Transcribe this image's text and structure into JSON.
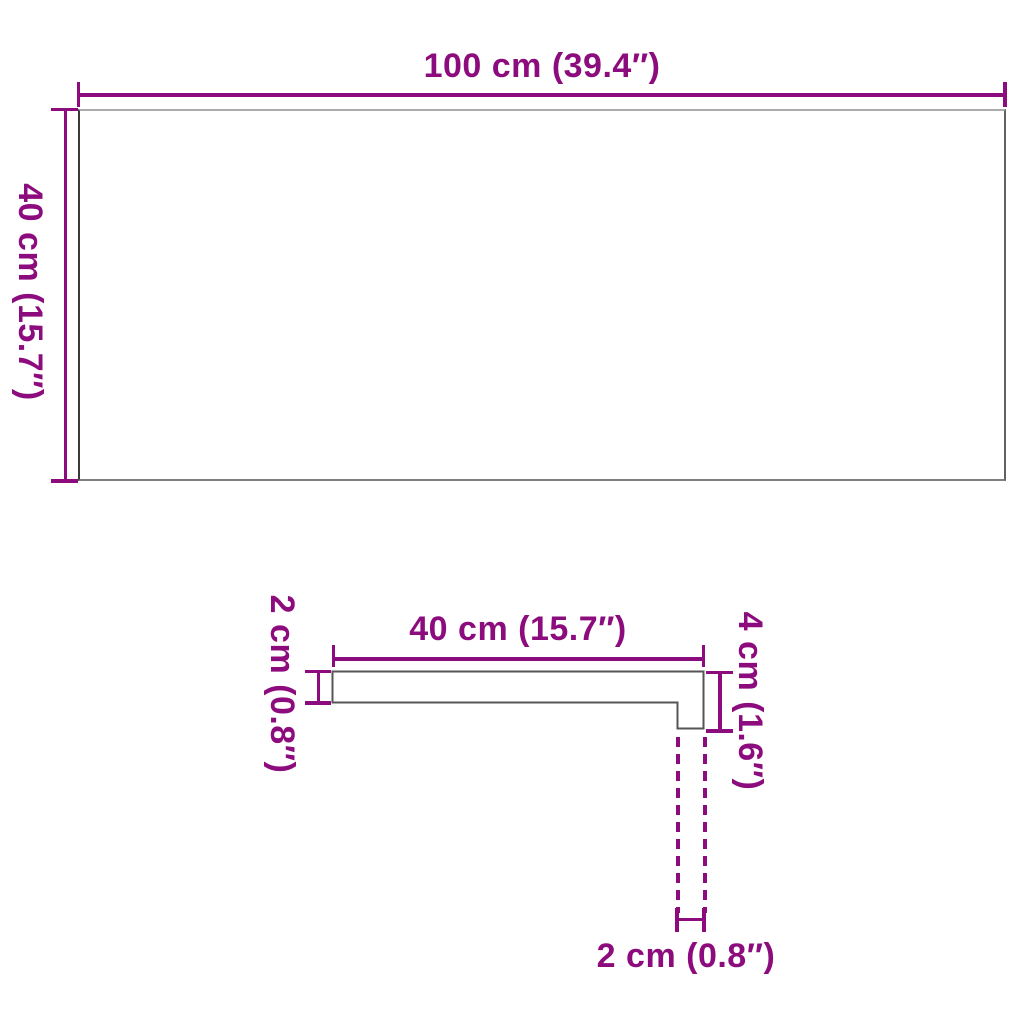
{
  "diagram": {
    "accent_color": "#8D0C7D",
    "top_view": {
      "width_label": "100 cm (39.4″)",
      "height_label": "40 cm (15.7″)"
    },
    "profile_view": {
      "thickness_label": "2 cm (0.8″)",
      "length_label": "40 cm (15.7″)",
      "height_label": "4 cm (1.6″)",
      "nose_label": "2 cm (0.8″)"
    }
  }
}
